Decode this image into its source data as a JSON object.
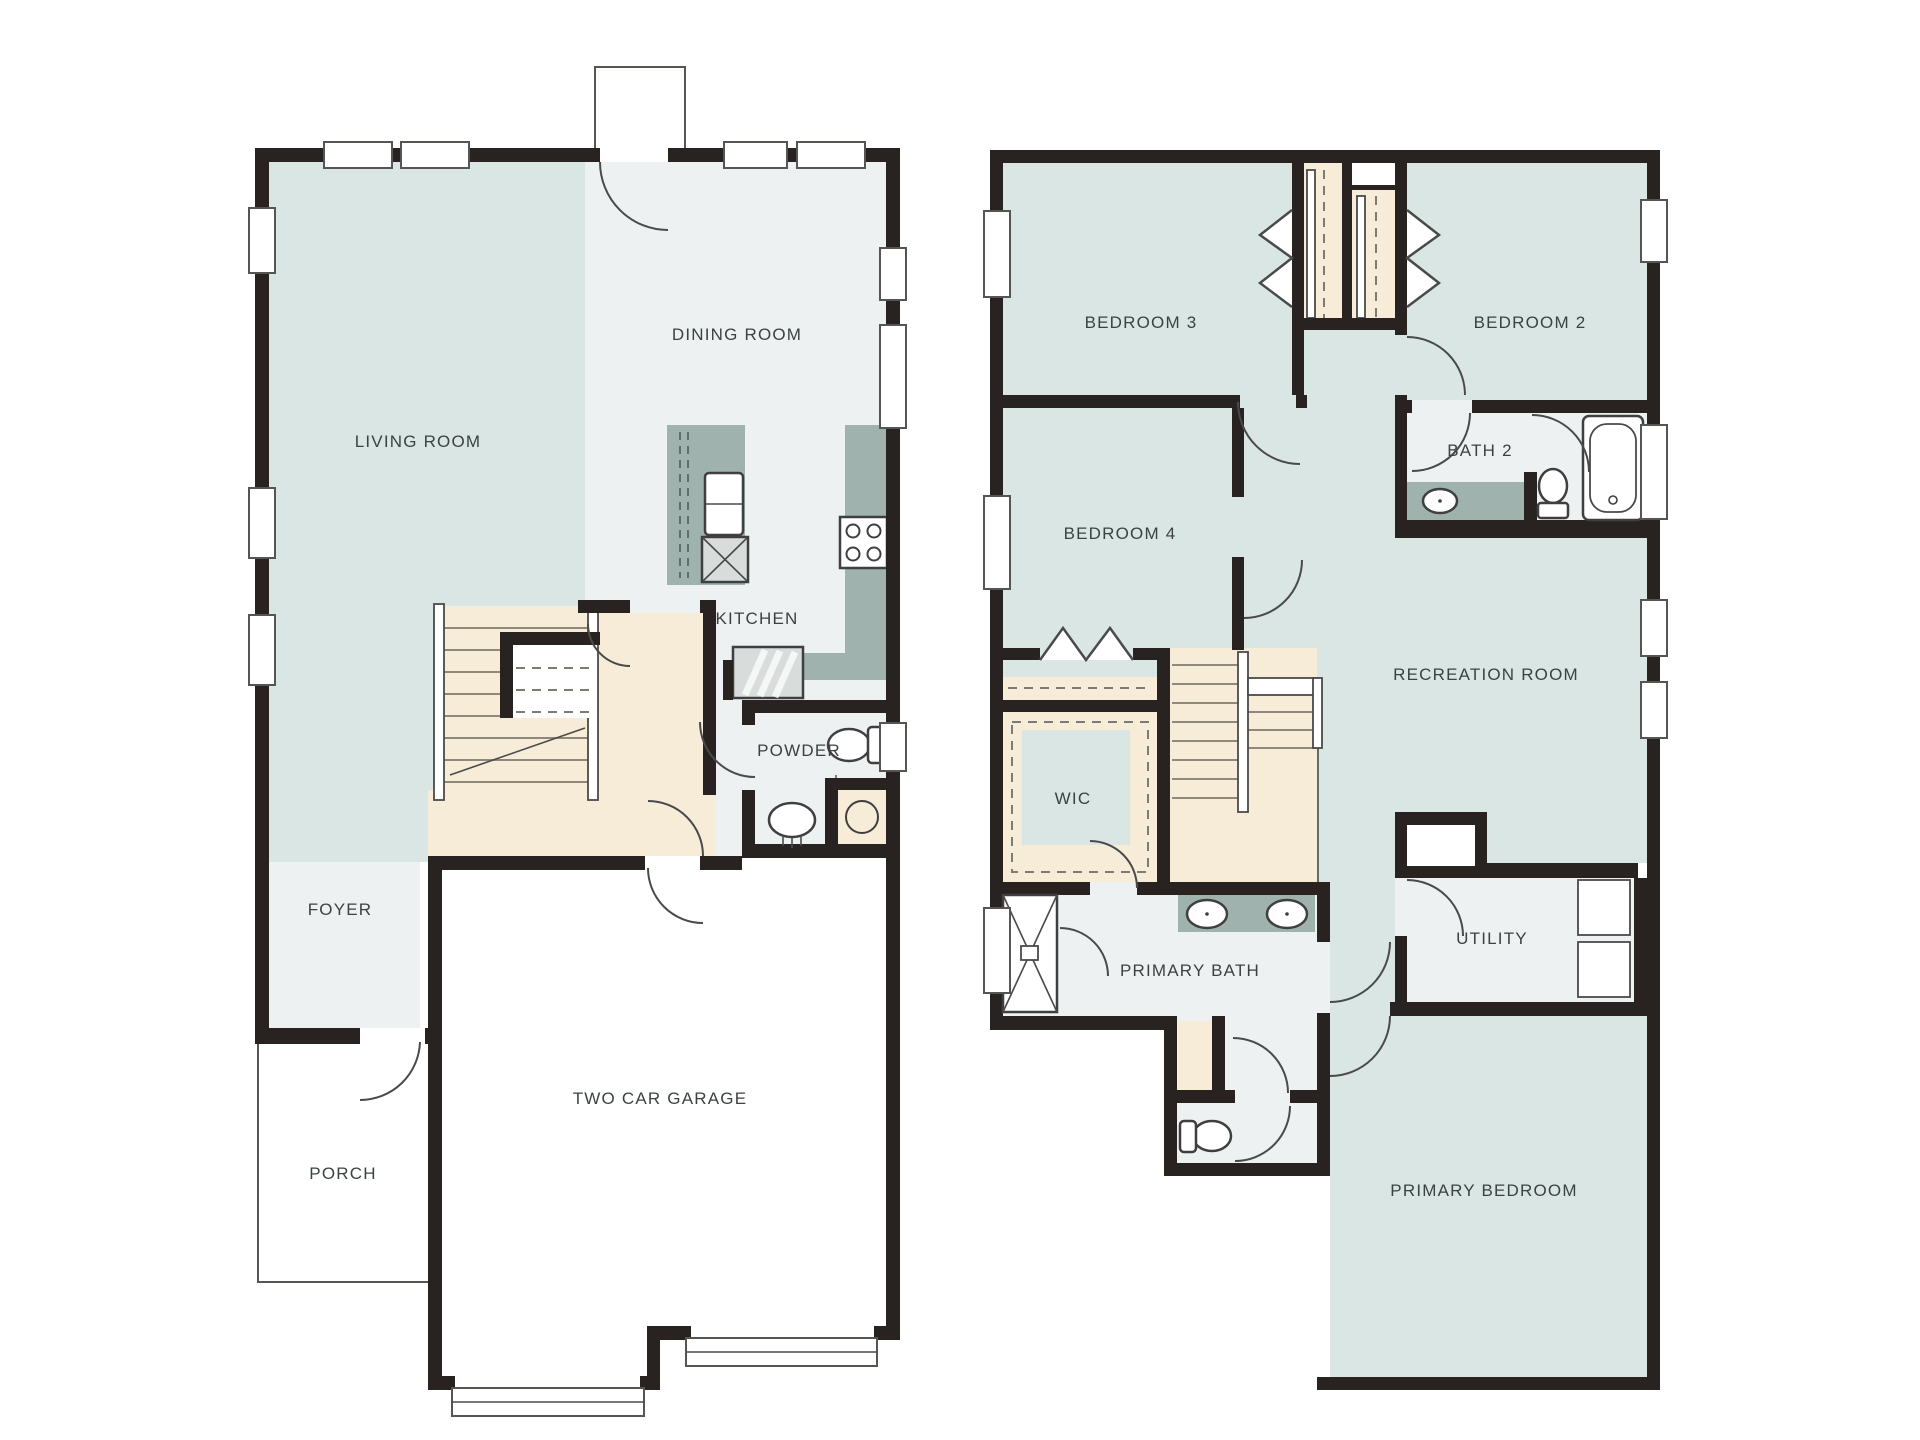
{
  "plan": {
    "floor1": {
      "living_room": "LIVING ROOM",
      "dining_room": "DINING ROOM",
      "kitchen": "KITCHEN",
      "powder": "POWDER",
      "foyer": "FOYER",
      "porch": "PORCH",
      "garage": "TWO CAR GARAGE"
    },
    "floor2": {
      "bedroom3": "BEDROOM 3",
      "bedroom2": "BEDROOM 2",
      "bedroom4": "BEDROOM 4",
      "bath2": "BATH 2",
      "recreation": "RECREATION ROOM",
      "wic": "WIC",
      "primary_bath": "PRIMARY BATH",
      "utility": "UTILITY",
      "primary_bedroom": "PRIMARY BEDROOM"
    },
    "colors": {
      "wall": "#282320",
      "room_teal": "#d9e6e3",
      "room_gray": "#edf1f1",
      "stairs_cream": "#f6ecd8",
      "counter_green": "#9fb2ad",
      "background": "#ffffff"
    }
  }
}
